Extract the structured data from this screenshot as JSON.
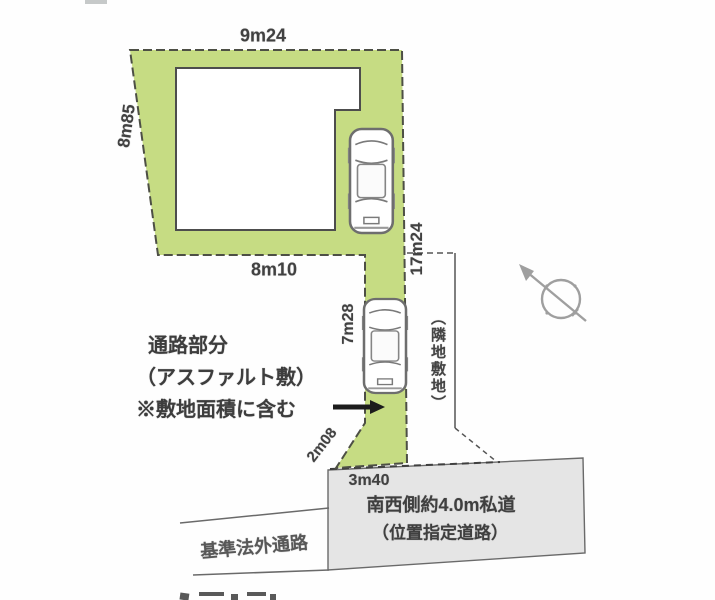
{
  "diagram": {
    "type": "real-estate-lot-plan",
    "dimensions": {
      "lot_top": "9m24",
      "lot_left": "8m85",
      "lot_bottom": "8m10",
      "lot_right": "17m24",
      "passage_length": "7m28",
      "passage_diagonal": "2m08",
      "road_frontage": "3m40"
    },
    "notes": {
      "passage_line1": "通路部分",
      "passage_line2": "（アスファルト敷）",
      "passage_line3": "※敷地面積に含む"
    },
    "labels": {
      "adjacent_lot": "（隣地敷地）",
      "road_line1": "南西側約4.0m私道",
      "road_line2": "（位置指定道路）",
      "nonstandard_passage": "基準法外通路"
    },
    "icons": {
      "compass": "north-arrow-compass-icon",
      "cars": "car-top-view-icon",
      "arrow": "black-right-arrow-icon"
    },
    "colors": {
      "lot_fill": "#c6dc83",
      "road_fill": "#e5e5e5",
      "outline": "#4d4f45",
      "text": "#414141",
      "compass_gray": "#8f8f8f"
    }
  }
}
